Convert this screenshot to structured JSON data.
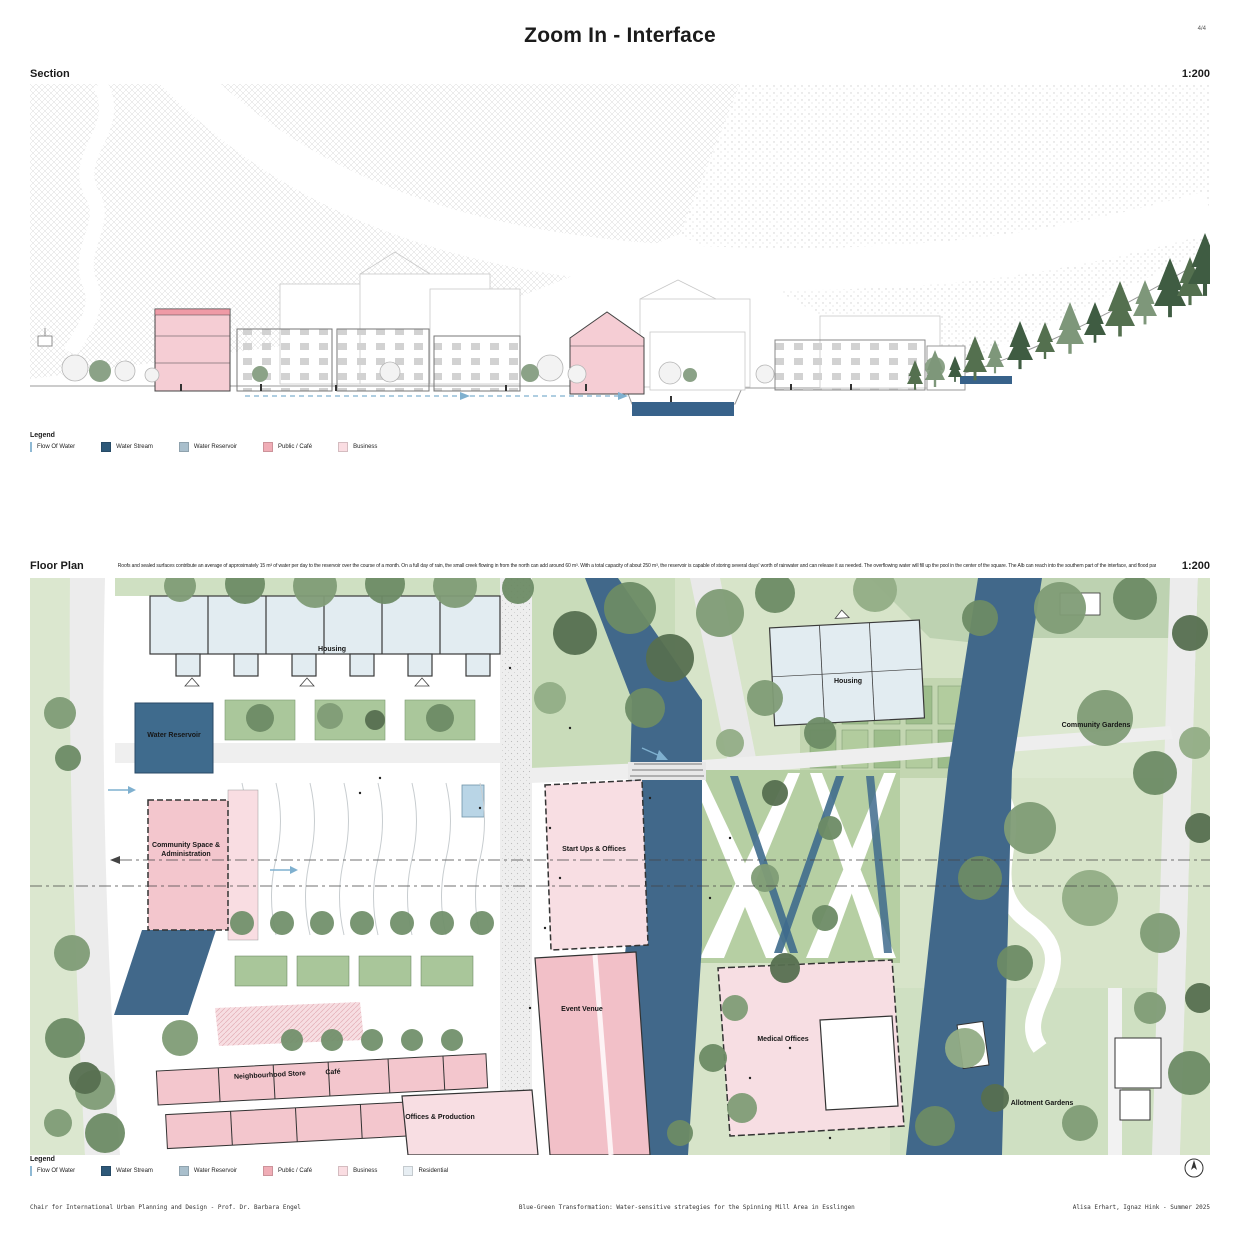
{
  "page": {
    "title": "Zoom In - Interface",
    "page_number": "4/4"
  },
  "section_panel": {
    "title": "Section",
    "scale": "1:200"
  },
  "floor_panel": {
    "title": "Floor Plan",
    "scale": "1:200",
    "description": "Roofs and sealed surfaces contribute an average of approximately 15 m³ of water per day to the reservoir over the course of a month. On a full day of rain, the small creek flowing in from the north can add around 60 m³. With a total capacity of about 250 m³, the reservoir is capable of storing several days' worth of rainwater and can release it as needed. The overflowing water will fill up the pool in the center of the square. The Alb can reach into the southern part of the interface, and flood parts of it."
  },
  "legend_top": {
    "title": "Legend",
    "items": [
      {
        "label": "Flow Of Water",
        "color": "#8fb9d4",
        "type": "line"
      },
      {
        "label": "Water Stream",
        "color": "#2d5878",
        "type": "square"
      },
      {
        "label": "Water Reservoir",
        "color": "#a9bfcc",
        "type": "square"
      },
      {
        "label": "Public / Café",
        "color": "#f0adb6",
        "type": "square"
      },
      {
        "label": "Business",
        "color": "#fadde2",
        "type": "square"
      }
    ]
  },
  "legend_bottom": {
    "title": "Legend",
    "items": [
      {
        "label": "Flow Of Water",
        "color": "#8fb9d4",
        "type": "line"
      },
      {
        "label": "Water Stream",
        "color": "#2d5878",
        "type": "square"
      },
      {
        "label": "Water Reservoir",
        "color": "#a9bfcc",
        "type": "square"
      },
      {
        "label": "Public / Café",
        "color": "#f0adb6",
        "type": "square"
      },
      {
        "label": "Business",
        "color": "#fadde2",
        "type": "square"
      },
      {
        "label": "Residential",
        "color": "#e7eef3",
        "type": "square"
      }
    ]
  },
  "plan_labels": {
    "housing_left": "Housing",
    "water_reservoir": "Water Reservoir",
    "community_space": "Community Space & Administration",
    "start_ups": "Start Ups & Offices",
    "event_venue": "Event Venue",
    "medical_offices": "Medical Offices",
    "neighbourhood_store": "Neighbourhood Store",
    "cafe": "Café",
    "offices_production": "Offices & Production",
    "housing_right": "Housing",
    "community_gardens": "Community Gardens",
    "allotment_gardens": "Allotment Gardens"
  },
  "footer": {
    "left": "Chair for International Urban Planning and Design - Prof. Dr. Barbara Engel",
    "center": "Blue-Green Transformation: Water-sensitive strategies for the Spinning Mill Area in Esslingen",
    "right": "Alisa Erhart, Ignaz Hink - Summer 2025"
  },
  "colors": {
    "water_dark": "#41688a",
    "water_reservoir": "#3f6b8d",
    "public_pink": "#f2c0c8",
    "business_pink": "#f8dee3",
    "residential_blue": "#e2ecf1",
    "park_green": "#d7e4c9"
  }
}
